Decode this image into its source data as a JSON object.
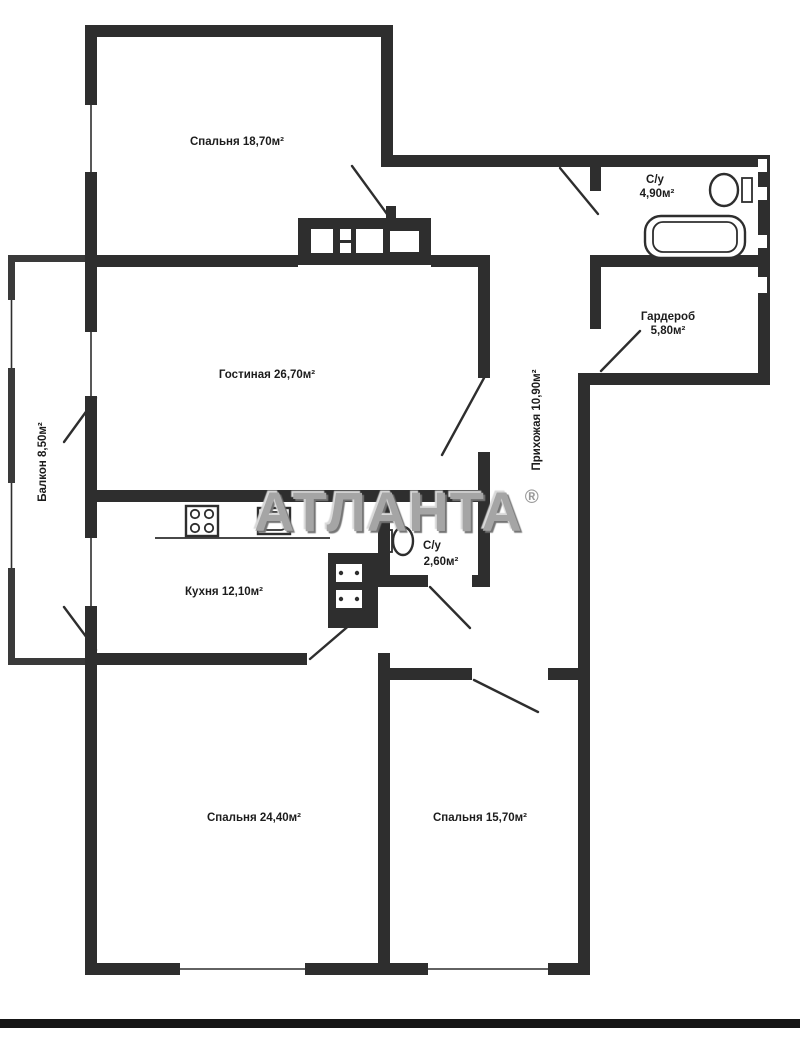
{
  "watermark": {
    "text": "АТЛАНТА",
    "mark": "®",
    "color": "#a5a5a5"
  },
  "rooms": {
    "bedroom_top": {
      "label": "Спальня 18,70м²"
    },
    "bathroom_main": {
      "name": "С/у",
      "area": "4,90м²"
    },
    "wardrobe": {
      "name": "Гардероб",
      "area": "5,80м²"
    },
    "living": {
      "label": "Гостиная 26,70м²"
    },
    "balcony": {
      "label": "Балкон 8,50м²"
    },
    "kitchen": {
      "label": "Кухня 12,10м²"
    },
    "bathroom_small": {
      "name": "С/у",
      "area": "2,60м²"
    },
    "hallway": {
      "label": "Прихожая 10,90м²"
    },
    "bedroom_left": {
      "label": "Спальня 24,40м²"
    },
    "bedroom_right": {
      "label": "Спальня 15,70м²"
    }
  },
  "colors": {
    "wall": "#2e2e2e",
    "background": "#ffffff",
    "watermark_gray": "#a5a5a5"
  }
}
